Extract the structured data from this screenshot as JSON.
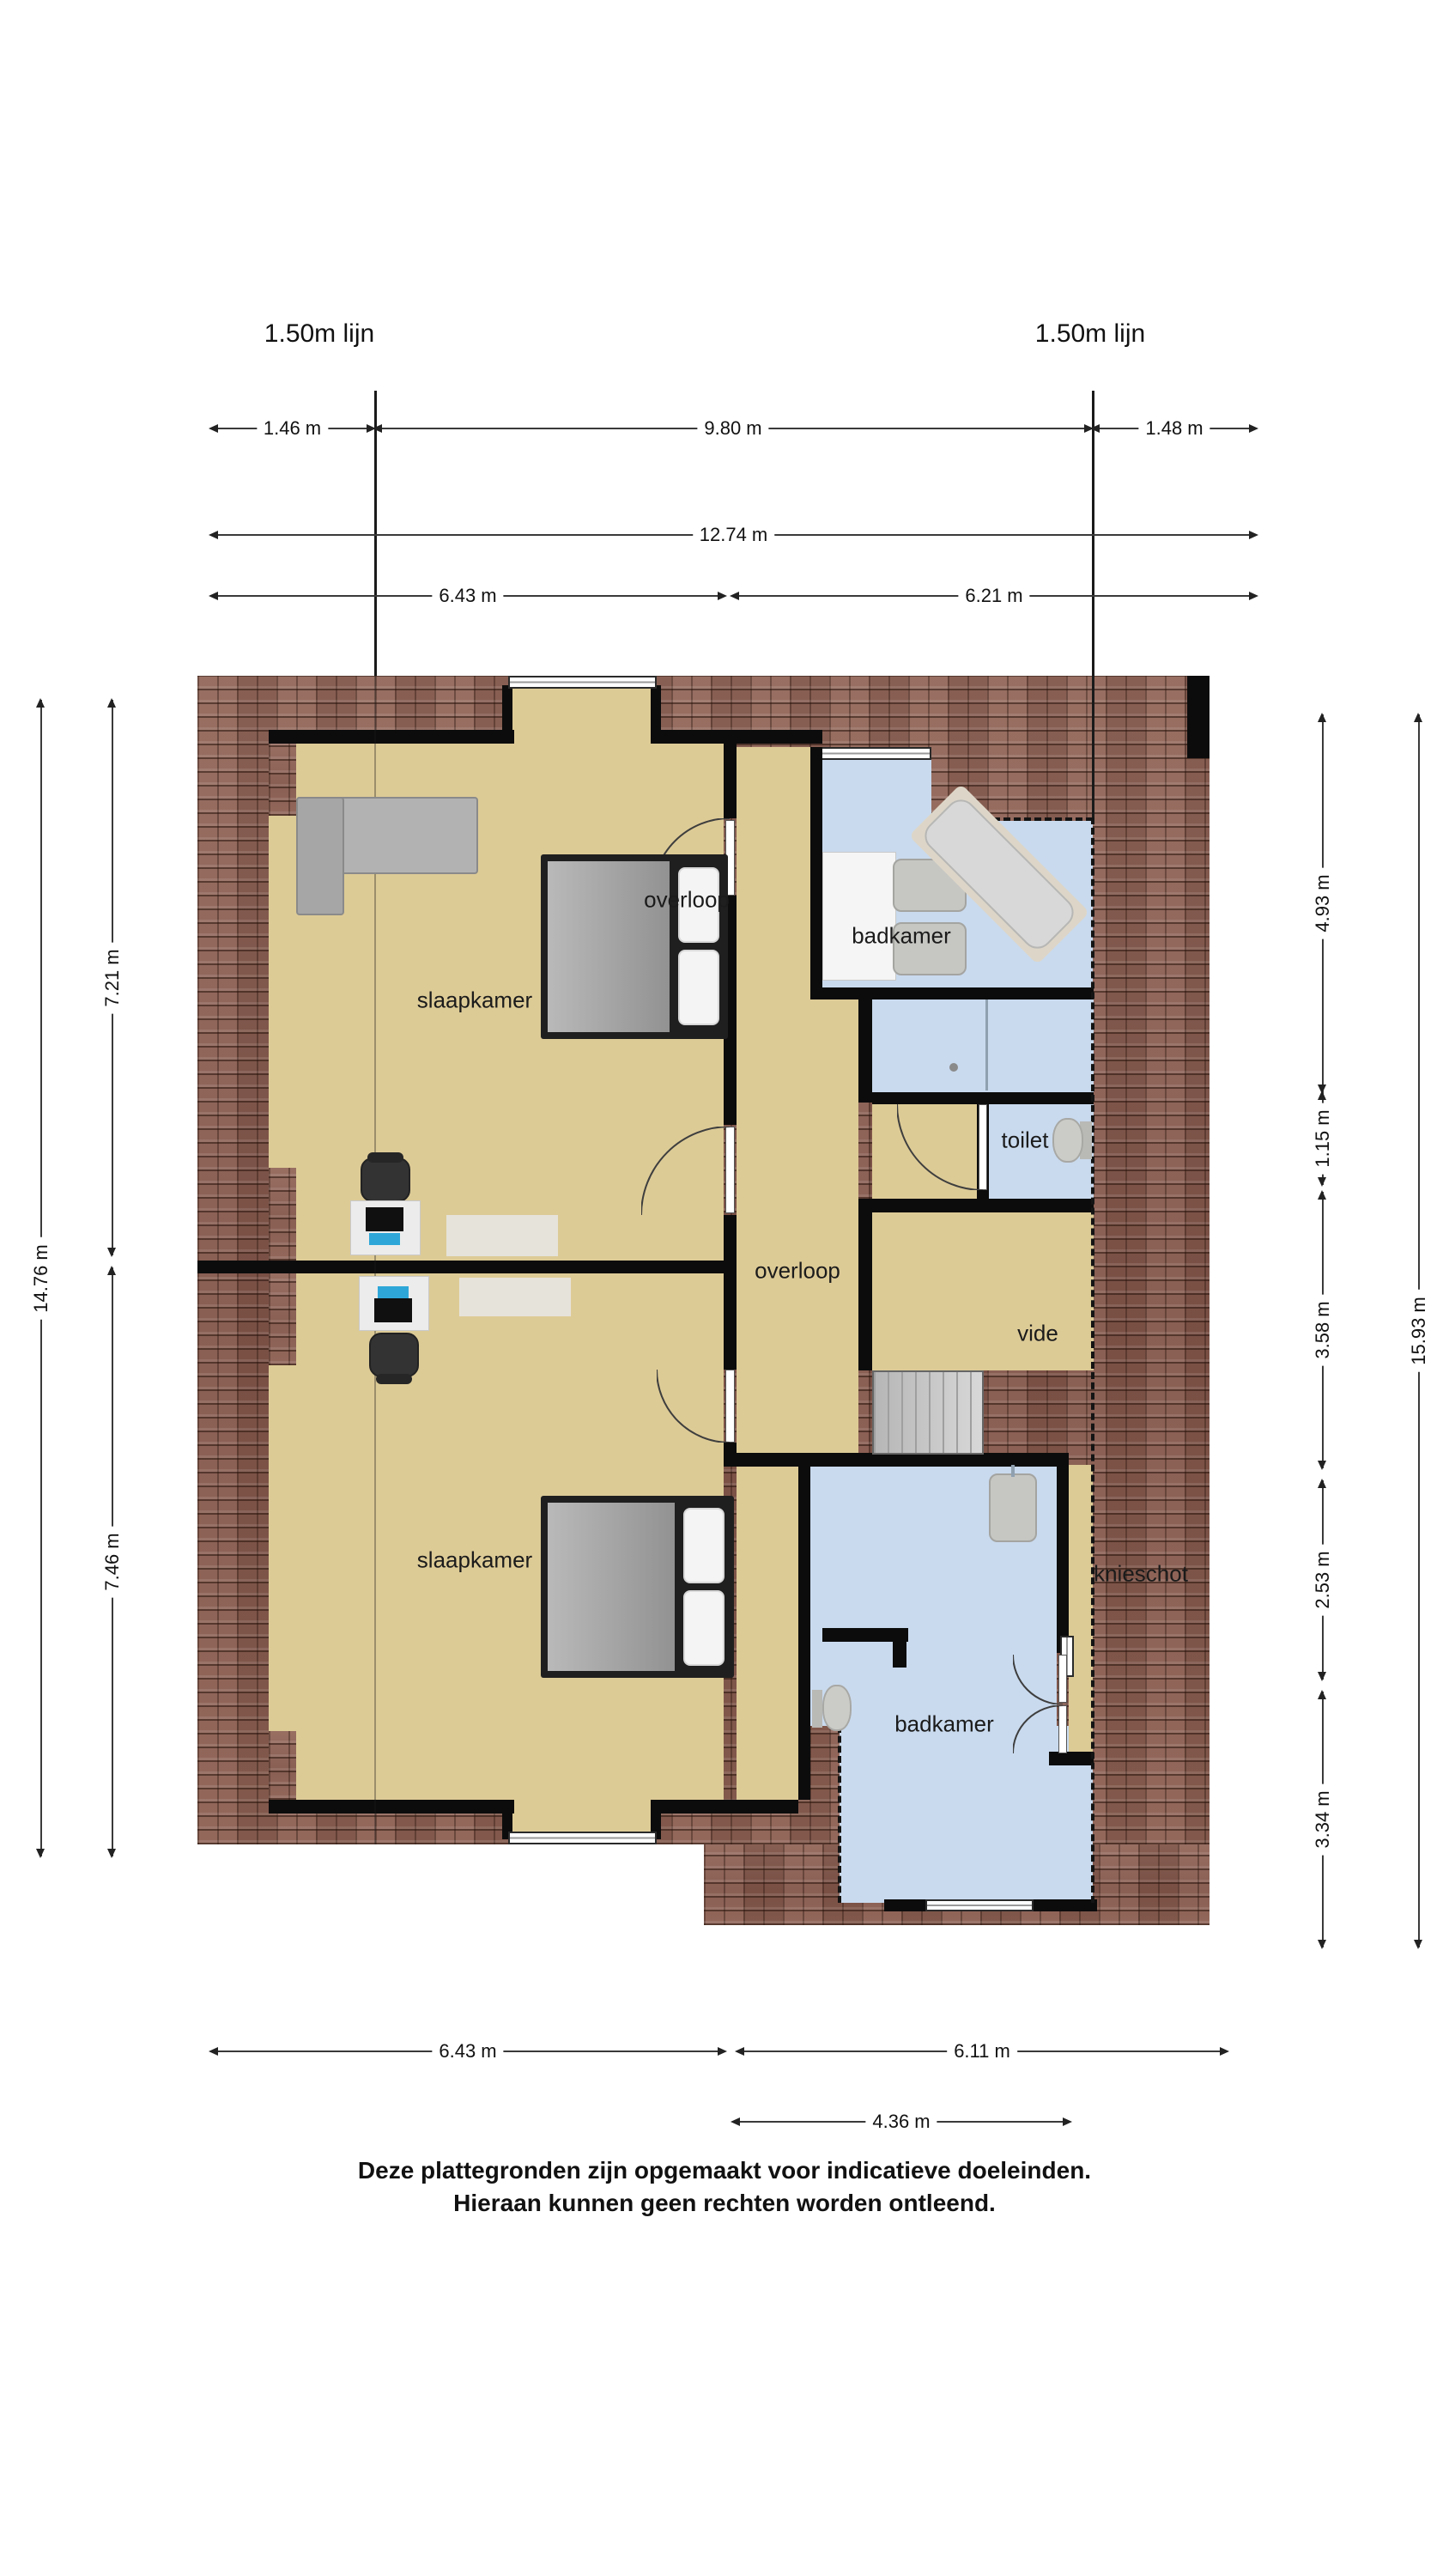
{
  "titles": {
    "lijn_left": "1.50m lijn",
    "lijn_right": "1.50m lijn"
  },
  "dims": {
    "top": [
      "1.46 m",
      "9.80 m",
      "1.48 m",
      "12.74 m",
      "6.43 m",
      "6.21 m"
    ],
    "left": [
      "7.21 m",
      "14.76 m",
      "7.46 m"
    ],
    "right": [
      "4.93 m",
      "1.15 m",
      "3.58 m",
      "2.53 m",
      "3.34 m",
      "15.93 m"
    ],
    "bottom": [
      "6.43 m",
      "6.11 m",
      "4.36 m"
    ]
  },
  "rooms": {
    "slaapkamer_top": "slaapkamer",
    "overloop_top": "overloop",
    "badkamer_top": "badkamer",
    "toilet": "toilet",
    "overloop": "overloop",
    "vide": "vide",
    "slaapkamer_bottom": "slaapkamer",
    "knieschot": "knieschot",
    "badkamer_bottom": "badkamer"
  },
  "disclaimer": {
    "line1": "Deze plattegronden zijn opgemaakt voor indicatieve doeleinden.",
    "line2": "Hieraan kunnen geen rechten worden ontleend."
  },
  "colors": {
    "roof": "#8a5b4c",
    "floor_bedroom": "#ddcb96",
    "floor_bath": "#c9daee",
    "wall": "#0c0c0c",
    "background": "#ffffff"
  }
}
